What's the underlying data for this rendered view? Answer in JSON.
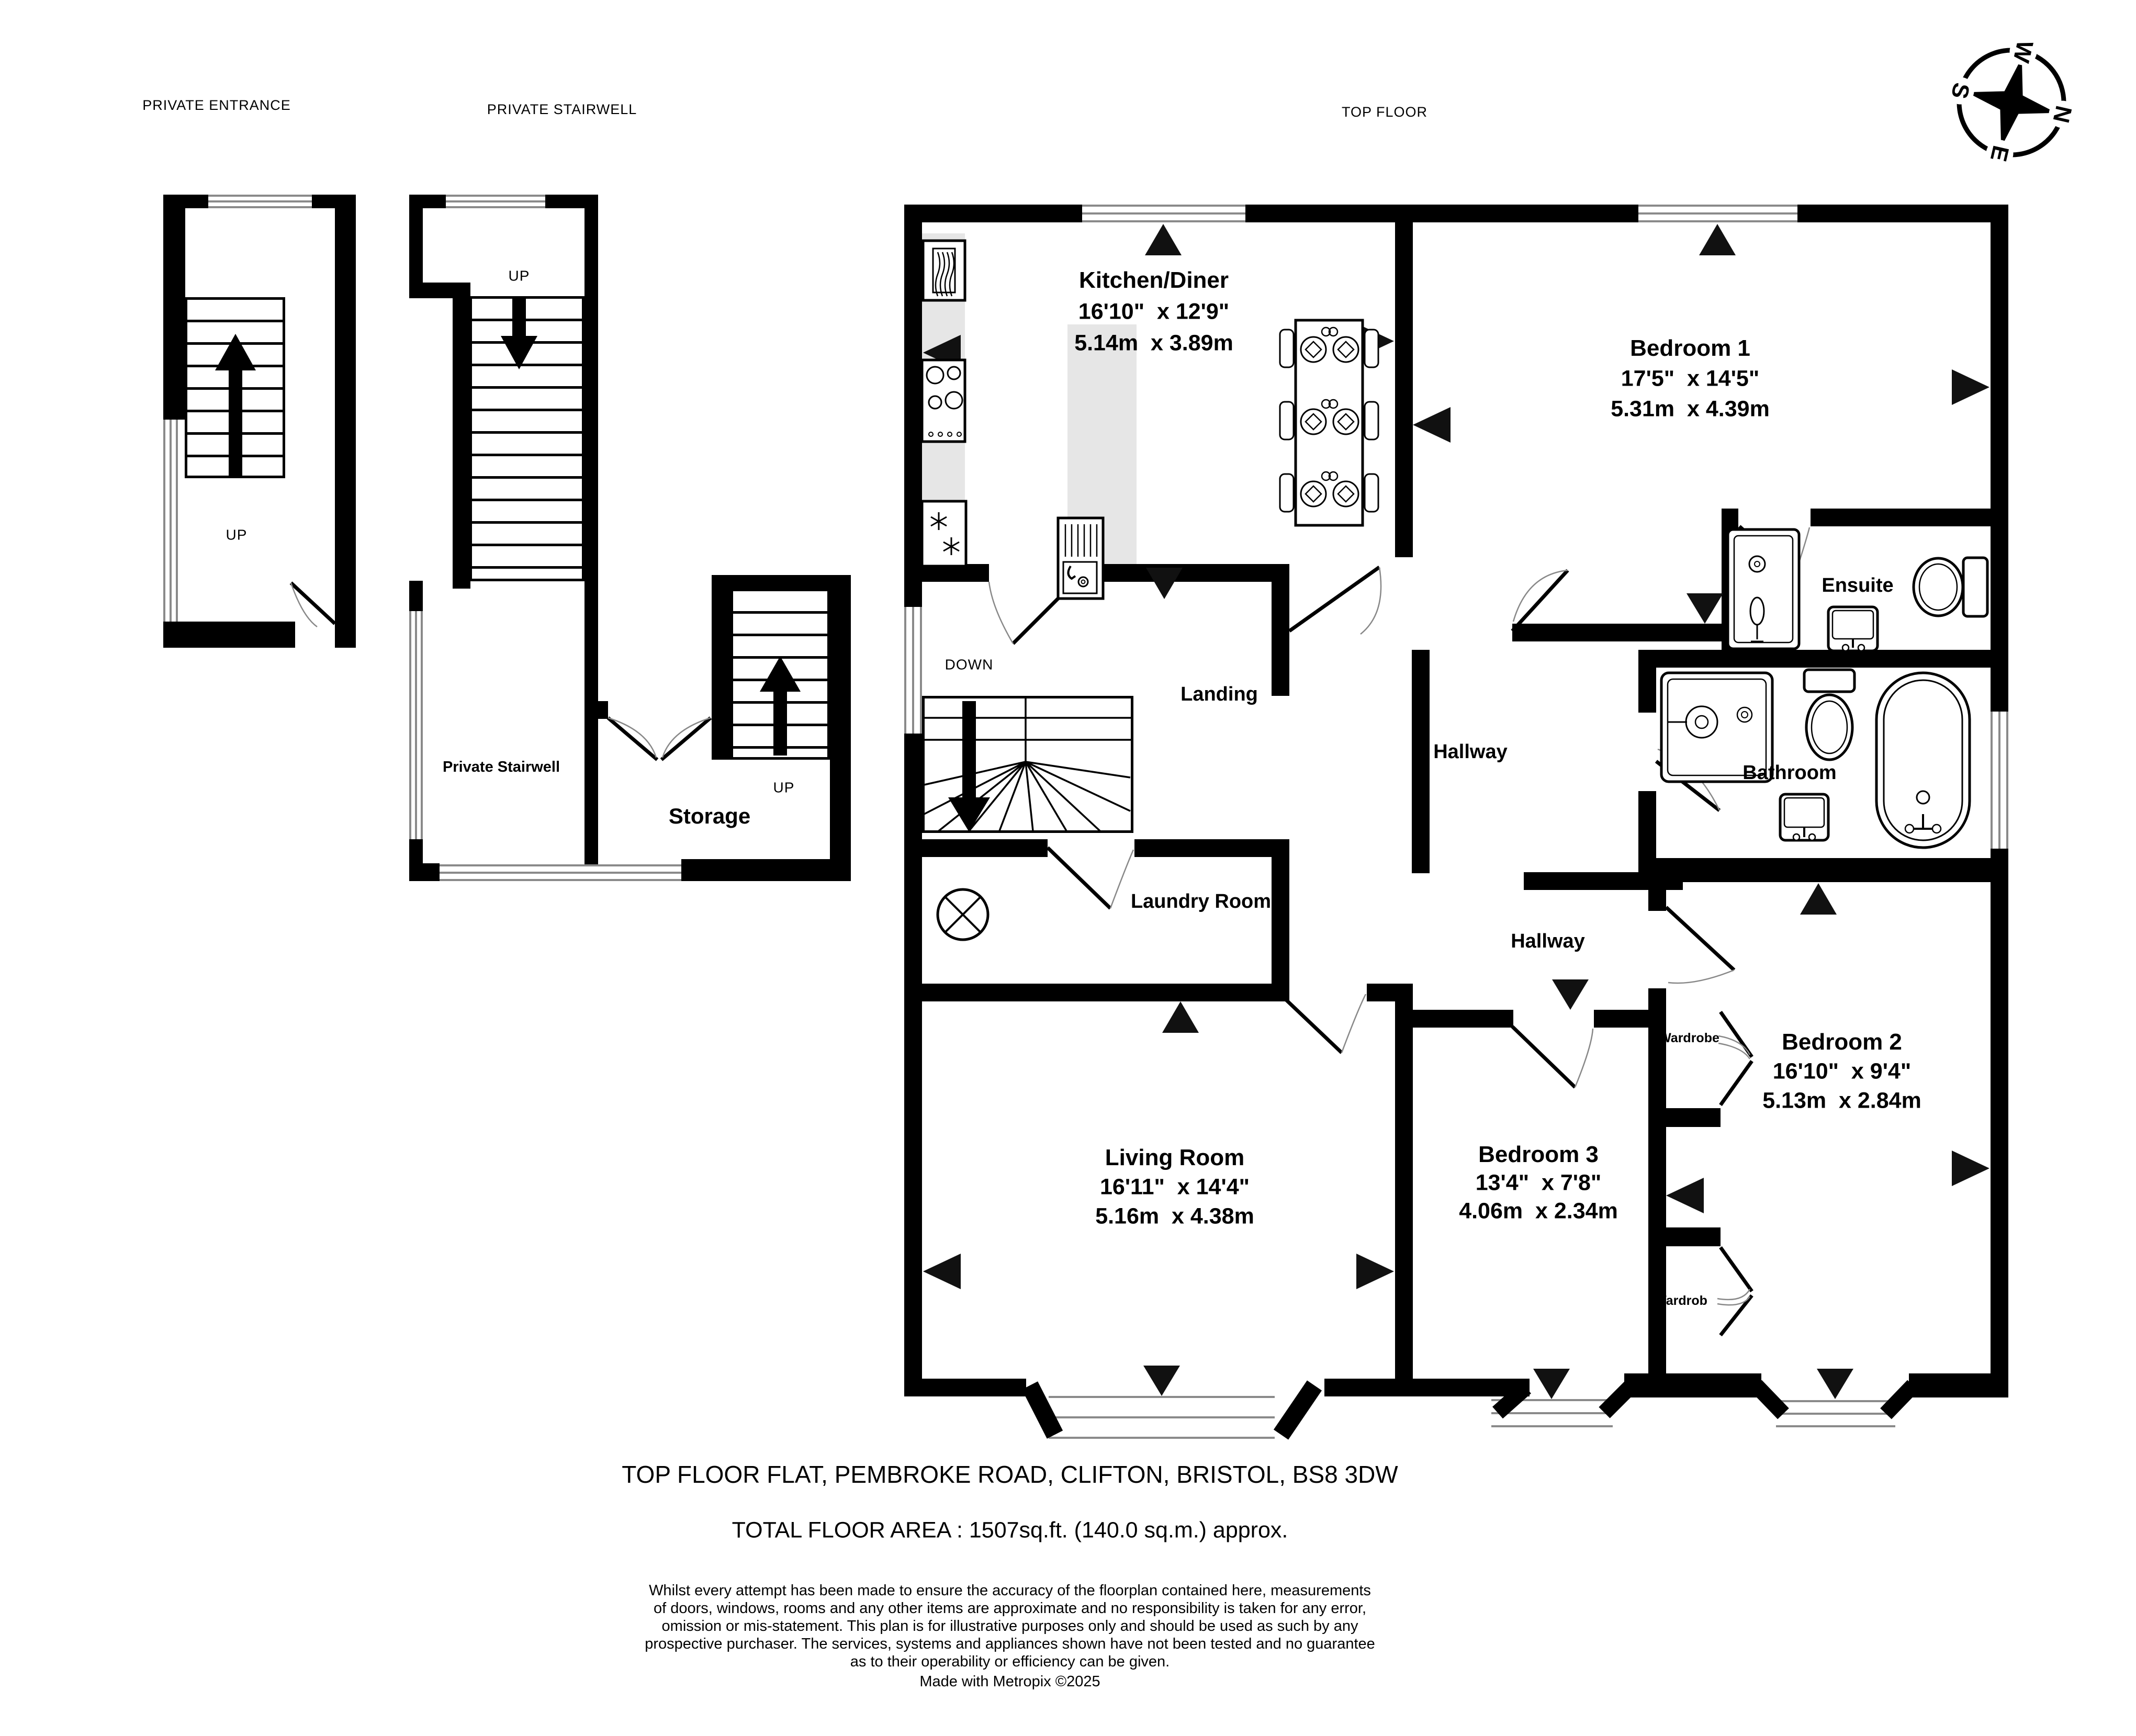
{
  "header": {
    "private_entrance": "PRIVATE ENTRANCE",
    "private_stairwell": "PRIVATE STAIRWELL",
    "top_floor": "TOP FLOOR"
  },
  "compass": {
    "n": "N",
    "e": "E",
    "s": "S",
    "w": "W"
  },
  "navigation": {
    "up": "UP",
    "down": "DOWN"
  },
  "rooms": {
    "kitchen": {
      "name": "Kitchen/Diner",
      "imperial": "16'10\"  x 12'9\"",
      "metric": "5.14m  x 3.89m"
    },
    "bedroom1": {
      "name": "Bedroom 1",
      "imperial": "17'5\"  x 14'5\"",
      "metric": "5.31m  x 4.39m"
    },
    "bedroom2": {
      "name": "Bedroom 2",
      "imperial": "16'10\"  x 9'4\"",
      "metric": "5.13m  x 2.84m"
    },
    "bedroom3": {
      "name": "Bedroom 3",
      "imperial": "13'4\"  x 7'8\"",
      "metric": "4.06m  x 2.34m"
    },
    "living_room": {
      "name": "Living Room",
      "imperial": "16'11\"  x 14'4\"",
      "metric": "5.16m  x 4.38m"
    },
    "ensuite": {
      "name": "Ensuite"
    },
    "bathroom": {
      "name": "Bathroom"
    },
    "landing": {
      "name": "Landing"
    },
    "hallway_upper": {
      "name": "Hallway"
    },
    "hallway_lower": {
      "name": "Hallway"
    },
    "laundry": {
      "name": "Laundry Room"
    },
    "storage": {
      "name": "Storage"
    },
    "private_stairwell": {
      "name": "Private Stairwell"
    },
    "wardrobe_upper": {
      "name": "Wardrobe"
    },
    "wardrobe_lower": {
      "name": "Wardrob"
    }
  },
  "footer": {
    "address": "TOP FLOOR FLAT, PEMBROKE ROAD, CLIFTON, BRISTOL, BS8 3DW",
    "total_area": "TOTAL FLOOR AREA : 1507sq.ft. (140.0 sq.m.) approx.",
    "disclaimer_lines": [
      "Whilst every attempt has been made to ensure the accuracy of the floorplan contained here, measurements",
      "of doors, windows, rooms and any other items are approximate and no responsibility is taken for any error,",
      "omission or mis-statement. This plan is for illustrative purposes only and should be used as such by any",
      "prospective purchaser. The services, systems and appliances shown have not been tested and no guarantee",
      "as to their operability or efficiency can be given."
    ],
    "credit": "Made with Metropix ©2025"
  },
  "colors": {
    "wall": "#000000",
    "counter": "#e6e6e6",
    "window_line": "#8a8a8a"
  }
}
